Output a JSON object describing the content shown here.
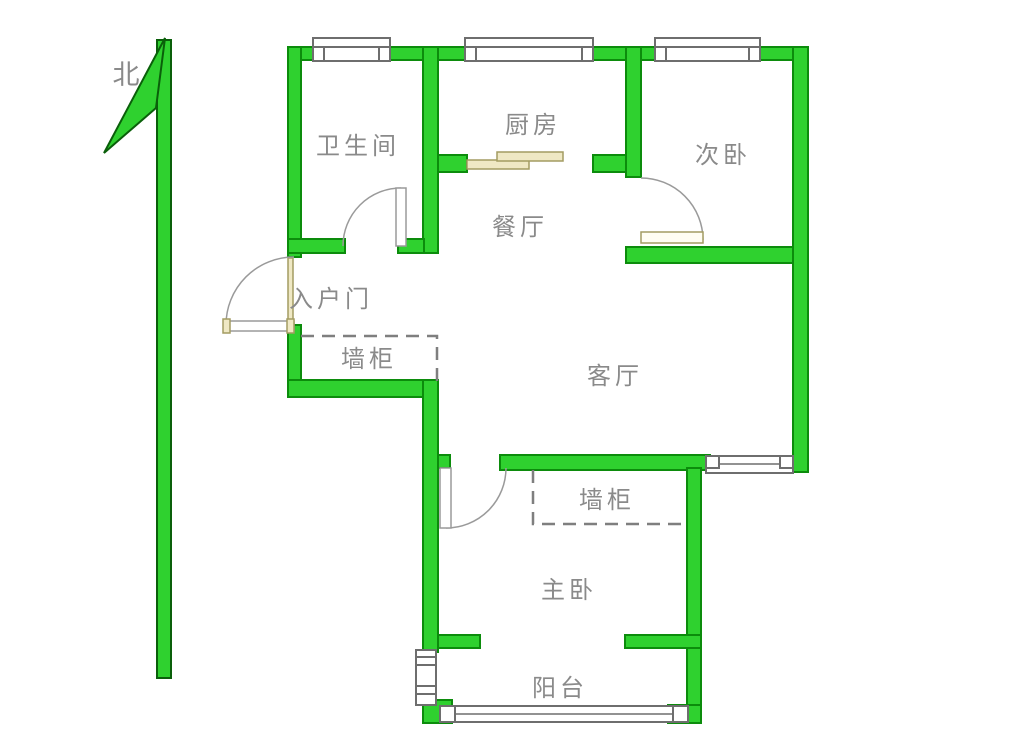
{
  "title": "apartment-floor-plan",
  "labels": {
    "north": "北",
    "bathroom": "卫生间",
    "kitchen": "厨房",
    "bedroom2": "次卧",
    "dining": "餐厅",
    "entry_door": "入户门",
    "wall_cabinet_top": "墙柜",
    "living": "客厅",
    "wall_cabinet_bottom": "墙柜",
    "master": "主卧",
    "balcony": "阳台"
  },
  "colors": {
    "background": "#ffffff",
    "wall_fill": "#2fd12f",
    "wall_stroke": "#0c8c0c",
    "arrow_stroke": "#0a5f0a",
    "window_stroke": "#6e6e6e",
    "line_gray": "#9a9a9a",
    "dash_gray": "#7f7f7f",
    "tan_fill": "#efe8c4",
    "tan_stroke": "#a39c62",
    "label_gray": "#8a8a8a"
  }
}
